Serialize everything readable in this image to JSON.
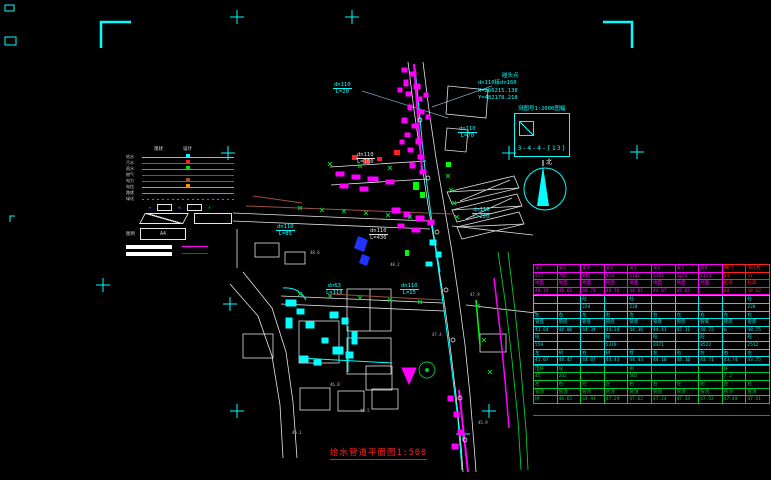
{
  "colors": {
    "background": "#000000",
    "cyan": "#00ffff",
    "magenta": "#ff00ff",
    "green": "#00cc33",
    "bright_green": "#00ff00",
    "red": "#ff2020",
    "white": "#ffffff",
    "blue": "#2233ff",
    "brown": "#9a5040",
    "orange": "#ff8c00",
    "gray": "#9a9a9a"
  },
  "annotation": {
    "point_label": "碰头点",
    "pipe": "dn110接dn160",
    "x_coord": "X=266215.138",
    "y_coord": "Y=482178.218"
  },
  "mapsheet": {
    "caption": "测图号1:2000图幅",
    "sheet_no": "3-4-4-[13]"
  },
  "north": {
    "label": "北"
  },
  "title": {
    "text": "给水管道平面图1:500"
  },
  "legend": {
    "header_left": "现状",
    "header_right": "设计",
    "footer_label": "图例",
    "footer_value": "A4",
    "rows": [
      {
        "label": "给水",
        "color": "#00ffff",
        "style": "solid",
        "marker": true
      },
      {
        "label": "污水",
        "color": "#ff2020",
        "style": "solid",
        "marker": true
      },
      {
        "label": "雨水",
        "color": "#00e000",
        "style": "solid",
        "marker": true
      },
      {
        "label": "燃气",
        "color": "#c03030",
        "style": "solid",
        "marker": false
      },
      {
        "label": "电力",
        "color": "#a0522d",
        "style": "solid",
        "marker": true
      },
      {
        "label": "电信",
        "color": "#ff8c00",
        "style": "solid",
        "marker": true
      },
      {
        "label": "路缘",
        "color": "#909090",
        "style": "solid",
        "marker": false
      },
      {
        "label": "绿化",
        "color": "#00c000",
        "style": "dotted",
        "marker": false
      }
    ]
  },
  "pipe_labels": [
    {
      "size": "dn110",
      "len": "L=20",
      "x": 333,
      "y": 82,
      "color": "#00ffff"
    },
    {
      "size": "dn110",
      "len": "L=70",
      "x": 458,
      "y": 126,
      "color": "#00ffff"
    },
    {
      "size": "dn110",
      "len": "L=160",
      "x": 356,
      "y": 152,
      "color": "#dddddd"
    },
    {
      "size": "dn110",
      "len": "L=220",
      "x": 472,
      "y": 207,
      "color": "#00ffff"
    },
    {
      "size": "dn110",
      "len": "L=85",
      "x": 276,
      "y": 224,
      "color": "#00ffff"
    },
    {
      "size": "dn110",
      "len": "L=430",
      "x": 369,
      "y": 228,
      "color": "#dddddd"
    },
    {
      "size": "dn63",
      "len": "L=118",
      "x": 326,
      "y": 283,
      "color": "#00ffff"
    },
    {
      "size": "dn110",
      "len": "L=15",
      "x": 400,
      "y": 283,
      "color": "#00ffff"
    }
  ],
  "spot_elevations": [
    {
      "v": "48.6",
      "x": 310,
      "y": 250
    },
    {
      "v": "48.2",
      "x": 390,
      "y": 262
    },
    {
      "v": "47.9",
      "x": 470,
      "y": 292
    },
    {
      "v": "47.4",
      "x": 432,
      "y": 332
    },
    {
      "v": "46.8",
      "x": 330,
      "y": 382
    },
    {
      "v": "46.1",
      "x": 292,
      "y": 430
    },
    {
      "v": "45.9",
      "x": 478,
      "y": 420
    },
    {
      "v": "46.5",
      "x": 360,
      "y": 408
    }
  ],
  "table": {
    "red_color": "#ff2020",
    "sections": [
      {
        "name": "head",
        "color": "#ff00ff",
        "red_cols": [
          8,
          9
        ],
        "rows": [
          [
            "支1",
            "支2",
            "支3",
            "支4",
            "支5",
            "支6",
            "支7",
            "支8",
            "阀门",
            "消火栓"
          ],
          [
            "977",
            "765",
            "842",
            "919",
            "1107",
            "1193",
            "1252",
            "1314",
            "84",
            "51"
          ],
          [
            "地面",
            "地面",
            "地面",
            "地面",
            "地面",
            "地面",
            "地面",
            "地面",
            "桩号",
            "标高"
          ],
          [
            "48.74",
            "48.63",
            "48.73",
            "48.76",
            "48.81",
            "44.87",
            "43.64",
            "",
            "68",
            "48.62"
          ]
        ]
      },
      {
        "name": "mid",
        "color": "#00e5e5",
        "red_cols": [],
        "rows": [
          [
            "",
            "",
            "砼",
            "",
            "砼",
            "",
            "",
            "",
            "",
            "砼"
          ],
          [
            "",
            "",
            "224",
            "",
            "228",
            "",
            "",
            "",
            "",
            "220"
          ],
          [
            "左",
            "右",
            "左",
            "右",
            "左",
            "右",
            "左",
            "右",
            "左",
            "右"
          ],
          [
            "管底",
            "管底",
            "管底",
            "管底",
            "管底",
            "管底",
            "管底",
            "管底",
            "管底",
            "管底"
          ],
          [
            "41.64",
            "44.06",
            "44.34",
            "44.34",
            "44.36",
            "44.41",
            "47.11",
            "48.72",
            "m",
            "48.75"
          ],
          [
            "砼",
            "",
            "",
            "砼",
            "",
            "砼",
            "",
            "砼",
            "",
            "砼"
          ],
          [
            "559",
            "",
            "",
            "5319",
            "",
            "3371",
            "",
            "8522",
            "",
            "2512"
          ],
          [
            "左",
            "树",
            "右",
            "树",
            "栓",
            "左",
            "右",
            "左",
            "右",
            "左"
          ],
          [
            "41.07",
            "44.47",
            "44.07",
            "44.43",
            "44.43",
            "44.10",
            "44.10",
            "43.71",
            "43.74",
            "43.75"
          ]
        ]
      },
      {
        "name": "foot",
        "color": "#00cc33",
        "red_cols": [],
        "rows": [
          [
            "电杆",
            "砼",
            "",
            "",
            "树",
            "",
            "",
            "",
            "杆",
            ""
          ],
          [
            "45",
            "202",
            "",
            "",
            "502",
            "",
            "",
            "",
            "7.2",
            ""
          ],
          [
            "左",
            "右",
            "砼",
            "左",
            "右",
            "右",
            "砼",
            "树",
            "左",
            "右"
          ],
          [
            "管顶",
            "管顶",
            "管顶",
            "管顶",
            "管顶",
            "管顶",
            "管顶",
            "管顶",
            "管顶",
            "管顶"
          ],
          [
            "树",
            "48.65",
            "44.94",
            "47.29",
            "47.62",
            "47.24",
            "47.34",
            "47.52",
            "47.49",
            "47.51"
          ]
        ]
      }
    ]
  }
}
